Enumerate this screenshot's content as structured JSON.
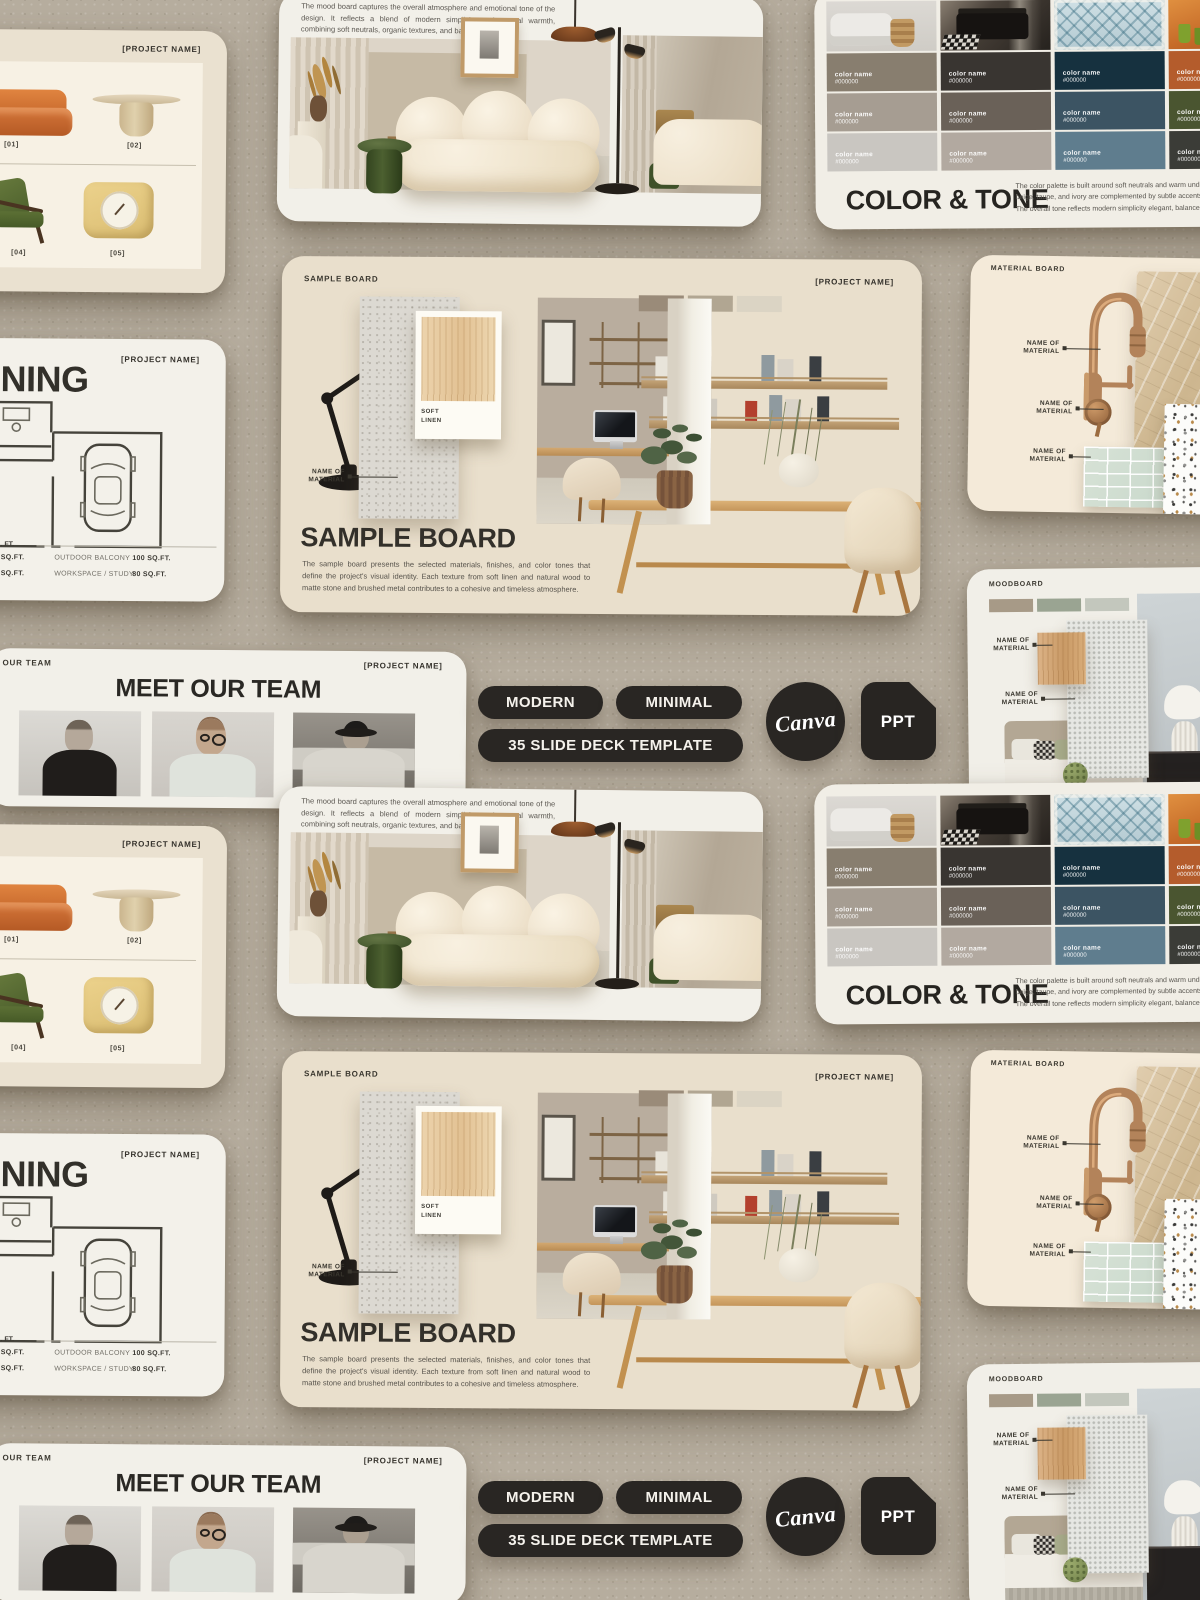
{
  "badges": {
    "tag_modern": "MODERN",
    "tag_minimal": "MINIMAL",
    "tag_deck": "35 SLIDE DECK TEMPLATE",
    "canva_logo": "Canva",
    "ppt_label": "PPT",
    "badge_color": "#292623"
  },
  "slides": {
    "furniture": {
      "project_name": "[PROJECT NAME]",
      "item_labels": [
        "[01]",
        "[02]",
        "[04]",
        "[05]"
      ]
    },
    "mood_board": {
      "description": "The mood board captures the overall atmosphere and emotional tone of the design. It reflects a blend of modern simplicity and natural warmth, combining soft neutrals, organic textures, and balanced contrasts."
    },
    "color_tone": {
      "title": "COLOR & TONE",
      "swatch_name": "color name",
      "swatch_hex": "#000000",
      "palette": [
        "#887e6f",
        "#393531",
        "#16313f",
        "#b45c2c",
        "#a69d92",
        "#6a6158",
        "#3c5463",
        "#4a5530",
        "#c9c6c1",
        "#b2a9a0",
        "#5f7d8e",
        "#3b3c37"
      ],
      "description_lines": [
        "The color palette is built around soft neutrals and warm undertones, creating a calm and",
        "beige, taupe, and ivory are complemented by subtle accents of wood and stone, enhan",
        "The overall tone reflects modern simplicity elegant, balanced, and effortlessly inviting."
      ]
    },
    "planning": {
      "title_fragment": "NING",
      "project_name": "[PROJECT NAME]",
      "area_note": ". FT.",
      "rows": [
        {
          "area": "0 SQ.FT.",
          "space": "OUTDOOR BALCONY",
          "value": "100 SQ.FT."
        },
        {
          "area": "0 SQ.FT.",
          "space": "WORKSPACE / STUDY",
          "value": "80 SQ.FT."
        }
      ]
    },
    "sample_board": {
      "header": "SAMPLE BOARD",
      "project_name": "[PROJECT NAME]",
      "swatch_caption": "SOFT LINEN",
      "material_label": "NAME OF MATERIAL",
      "title": "SAMPLE BOARD",
      "description": "The sample board presents the selected materials, finishes, and color tones that define the project's visual identity. Each texture from soft linen and natural wood to matte stone and brushed metal contributes to a cohesive and timeless atmosphere.",
      "mini_swatches": [
        "#9a8b79",
        "#b1a692",
        "#dbd4c4"
      ]
    },
    "material_board": {
      "header": "MATERIAL BOARD",
      "material_label": "NAME OF MATERIAL"
    },
    "team": {
      "corner_label": "OUR TEAM",
      "project_name": "[PROJECT NAME]",
      "title": "MEET OUR TEAM"
    },
    "moodboard": {
      "header": "MOODBOARD",
      "material_label": "NAME OF MATERIAL",
      "mini_swatches": [
        "#a79a87",
        "#9aa492",
        "#c3c7bd"
      ]
    }
  }
}
